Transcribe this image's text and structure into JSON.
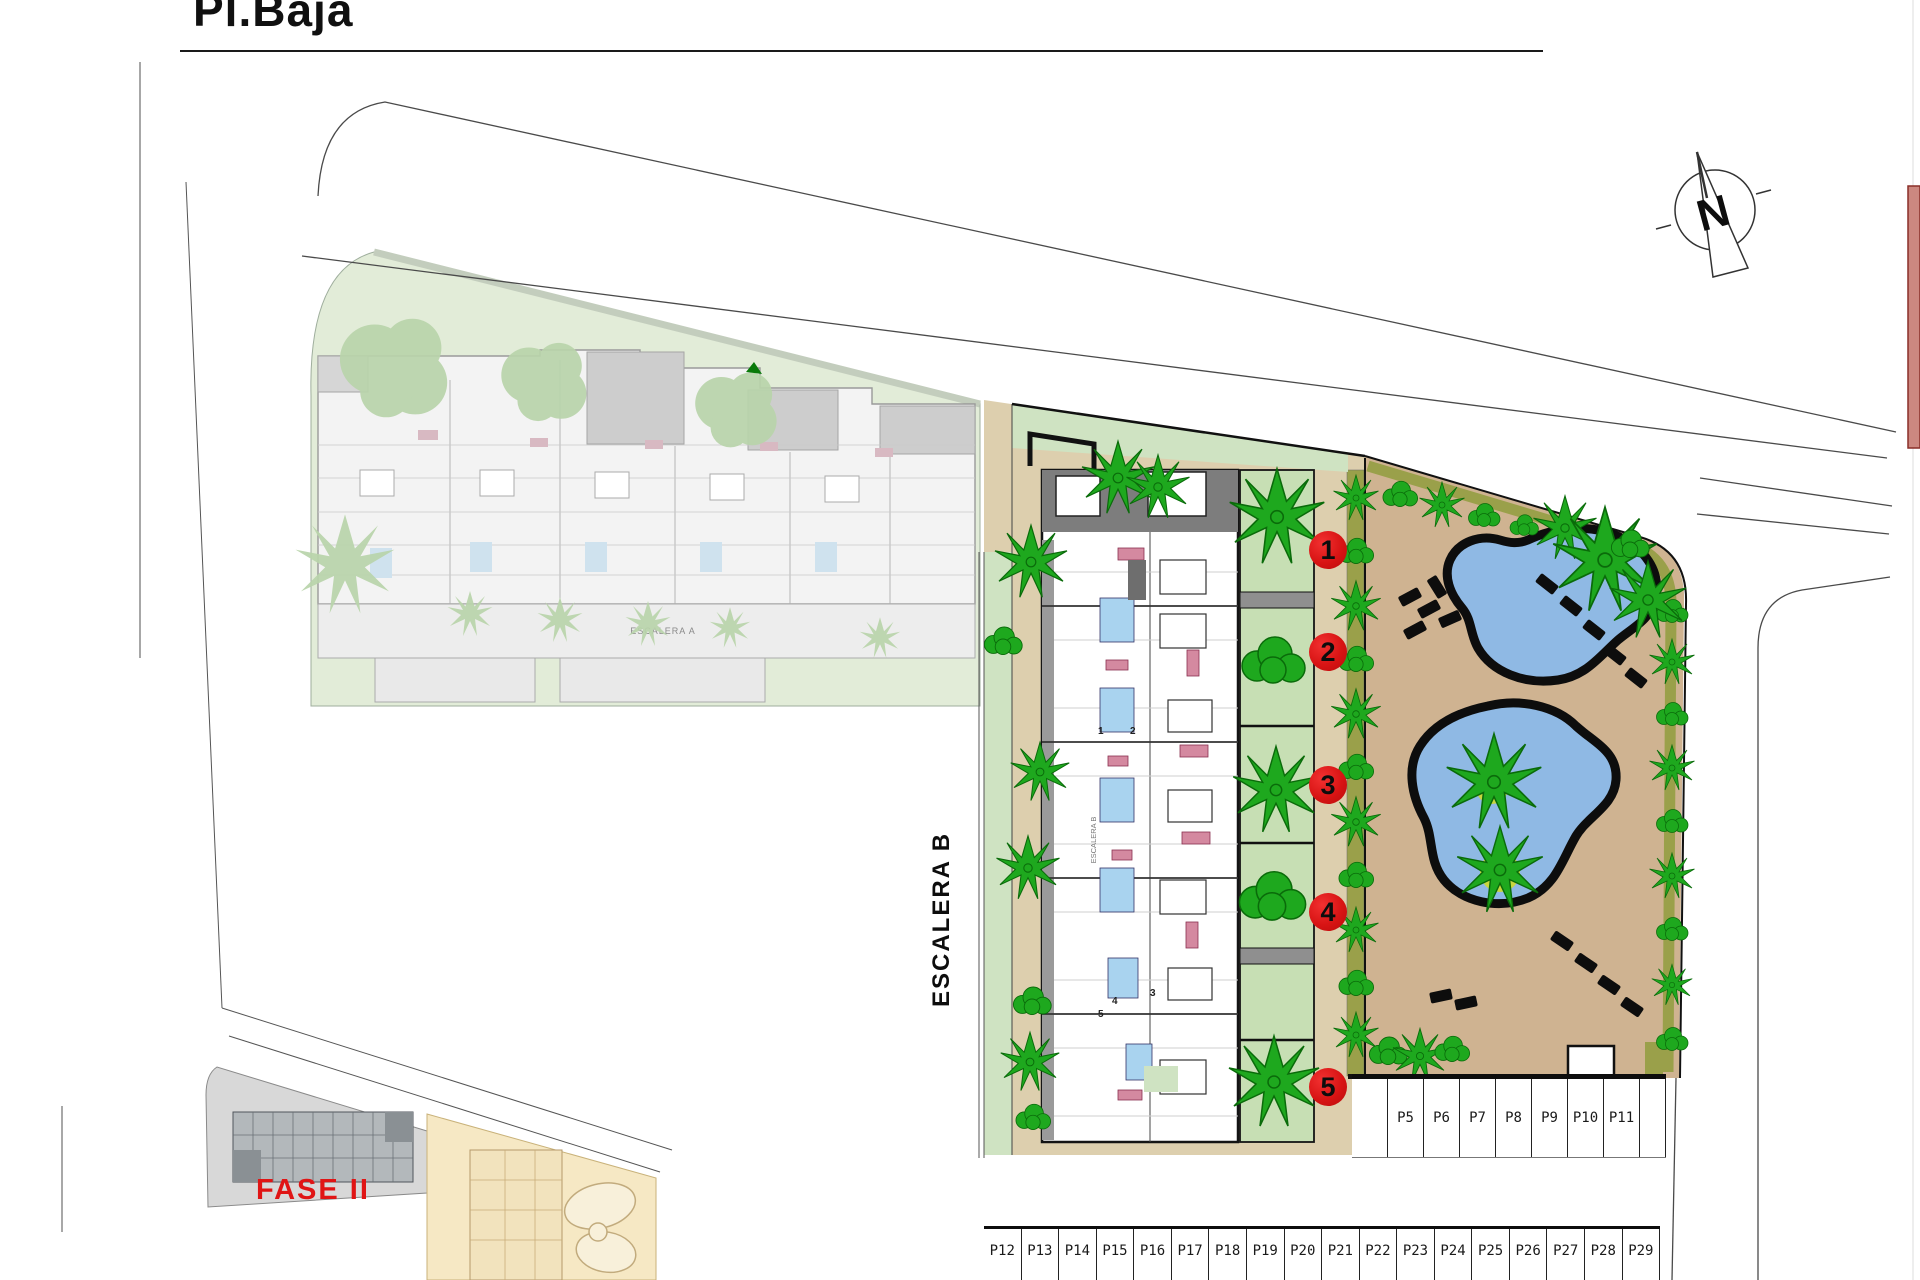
{
  "title": "Pl.Baja",
  "compass": {
    "letter": "N"
  },
  "labels": {
    "escalera_b": "ESCALERA B",
    "escalera_a": "ESCALERA A",
    "fase_ii": "FASE II"
  },
  "unit_markers": [
    {
      "label": "1",
      "y": 531
    },
    {
      "label": "2",
      "y": 633
    },
    {
      "label": "3",
      "y": 766
    },
    {
      "label": "4",
      "y": 893
    },
    {
      "label": "5",
      "y": 1068
    }
  ],
  "plan_numbers": [
    {
      "label": "1",
      "x": 1098,
      "y": 726
    },
    {
      "label": "2",
      "x": 1130,
      "y": 726
    },
    {
      "label": "3",
      "x": 1150,
      "y": 988
    },
    {
      "label": "4",
      "x": 1112,
      "y": 996
    },
    {
      "label": "5",
      "x": 1098,
      "y": 1009
    }
  ],
  "parking": {
    "upper": [
      "",
      "P5",
      "P6",
      "P7",
      "P8",
      "P9",
      "P10",
      "P11",
      ""
    ],
    "lower": [
      "P12",
      "P13",
      "P14",
      "P15",
      "P16",
      "P17",
      "P18",
      "P19",
      "P20",
      "P21",
      "P22",
      "P23",
      "P24",
      "P25",
      "P26",
      "P27",
      "P28",
      "P29"
    ]
  },
  "colors": {
    "marker_red": "#d81414",
    "fase_red": "#e01515",
    "tree_green": "#1ea81e",
    "pale_lawn": "#cfe3c2",
    "faded_lawn": "#e2ecd8",
    "courtyard_sand": "#ddcfae",
    "pool_sand": "#cfb391",
    "olive": "#9aa04a",
    "pool_blue": "#8fb9e4",
    "road_gray": "#d9d9d9"
  }
}
